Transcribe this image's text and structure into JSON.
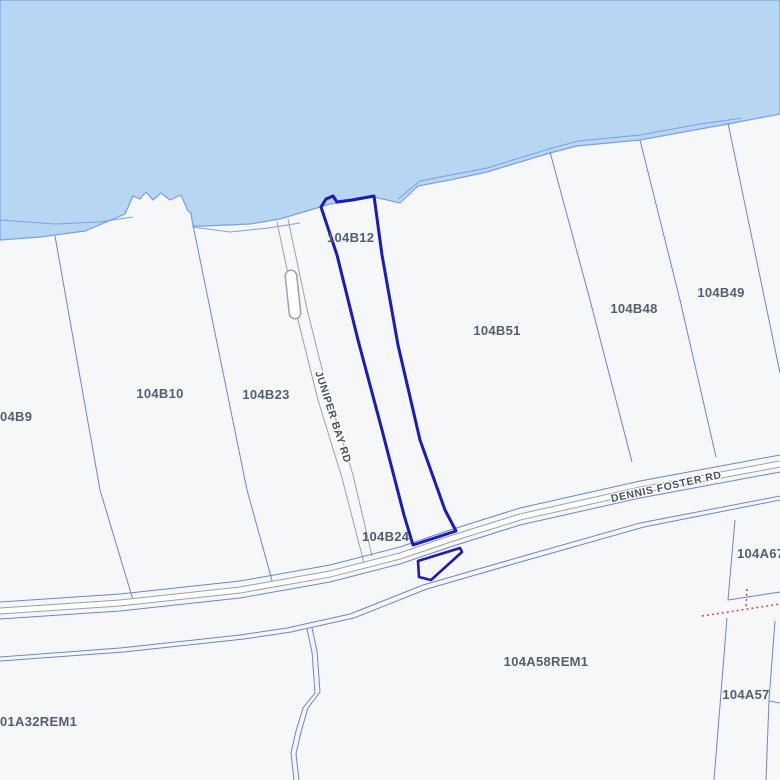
{
  "map": {
    "selected_parcel": "104B12",
    "parcel_labels": {
      "b12": "104B12",
      "b24": "104B24",
      "b51": "104B51",
      "b48": "104B48",
      "b49": "104B49",
      "b10": "104B10",
      "b23": "104B23",
      "b9": "04B9",
      "a58": "104A58REM1",
      "a57": "104A57",
      "a67": "104A67",
      "a32": "01A32REM1"
    },
    "road_labels": {
      "juniper": "JUNIPER BAY RD",
      "dennis": "DENNIS FOSTER RD"
    }
  },
  "colors": {
    "water": "#b7d6f2",
    "land": "#f6f7f9",
    "shore": "#7d9fe3",
    "parcel-line": "#6f83d8",
    "road-casing": "#9aa1ad",
    "road-fill": "#ffffff",
    "selected": "#1a1abf",
    "survey-red": "#e04f4f",
    "label": "#555d70",
    "road-label": "#4a5160"
  }
}
